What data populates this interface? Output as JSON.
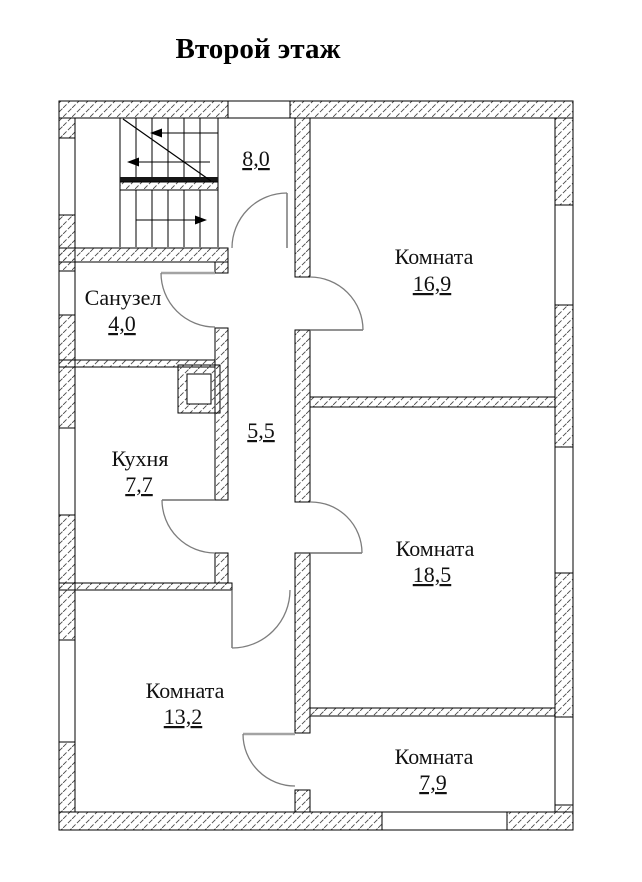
{
  "title": "Второй этаж",
  "rooms": {
    "stair_hall": {
      "area": "8,0"
    },
    "bathroom": {
      "name": "Санузел",
      "area": "4,0"
    },
    "kitchen": {
      "name": "Кухня",
      "area": "7,7"
    },
    "hallway": {
      "area": "5,5"
    },
    "room_top": {
      "name": "Комната",
      "area": "16,9"
    },
    "room_mid": {
      "name": "Комната",
      "area": "18,5"
    },
    "room_left": {
      "name": "Комната",
      "area": "13,2"
    },
    "room_bot": {
      "name": "Комната",
      "area": "7,9"
    }
  },
  "colors": {
    "wall_outline": "#000000",
    "hatch_line": "#4a4a4a",
    "door": "#7d7d7d",
    "background": "#ffffff"
  }
}
